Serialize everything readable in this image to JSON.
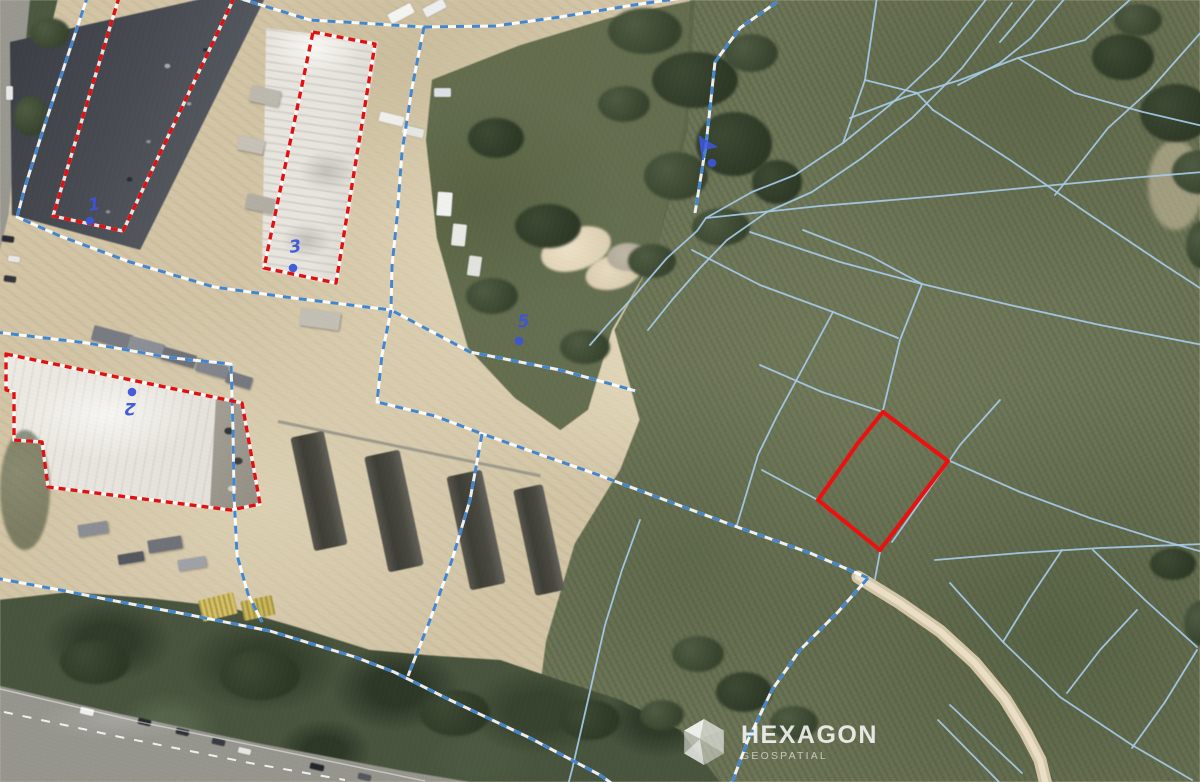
{
  "map": {
    "description": "aerial-cadastral-imagery",
    "watermark": {
      "line1": "HEXAGON",
      "line2": "GEOSPATIAL"
    },
    "colors": {
      "cadastral_line": "#a6cbe9",
      "boundary_dash": "#4286cf",
      "selection_red": "#ee0f0f",
      "label_blue": "#3b55d8",
      "field_green": "#6c7454",
      "sand": "#d4c5a4"
    },
    "parcel_labels": [
      {
        "text": "1",
        "x": 95,
        "y": 210,
        "rot": -10,
        "dot": [
          90,
          221
        ]
      },
      {
        "text": "3",
        "x": 296,
        "y": 252,
        "rot": -8,
        "dot": [
          293,
          268
        ]
      },
      {
        "text": "5",
        "x": 524,
        "y": 327,
        "rot": -5,
        "dot": [
          519,
          341
        ]
      },
      {
        "text": "2",
        "x": 130,
        "y": 403,
        "rot": 180,
        "dot": [
          132,
          392
        ]
      }
    ],
    "flag_marker": {
      "pole": [
        [
          700,
          136
        ],
        [
          703,
          160
        ]
      ],
      "pennant": [
        [
          699,
          136
        ],
        [
          718,
          147
        ],
        [
          701,
          151
        ]
      ],
      "dot": [
        712,
        163
      ]
    }
  },
  "overlay": {
    "boundary_lines": [
      {
        "points": [
          [
            88,
            -5
          ],
          [
            43,
            130
          ],
          [
            25,
            187
          ],
          [
            17,
            217
          ],
          [
            60,
            236
          ],
          [
            130,
            262
          ],
          [
            214,
            287
          ],
          [
            293,
            298
          ],
          [
            391,
            310
          ],
          [
            470,
            352
          ],
          [
            560,
            370
          ],
          [
            636,
            391
          ]
        ]
      },
      {
        "points": [
          [
            235,
            -3
          ],
          [
            310,
            20
          ],
          [
            424,
            27
          ],
          [
            412,
            88
          ],
          [
            402,
            152
          ],
          [
            397,
            218
          ],
          [
            392,
            266
          ],
          [
            391,
            310
          ]
        ]
      },
      {
        "points": [
          [
            424,
            27
          ],
          [
            495,
            26
          ],
          [
            560,
            17
          ],
          [
            640,
            4
          ],
          [
            690,
            -3
          ]
        ]
      },
      {
        "points": [
          [
            777,
            2
          ],
          [
            740,
            28
          ],
          [
            715,
            62
          ],
          [
            706,
            145
          ],
          [
            695,
            213
          ]
        ]
      },
      {
        "points": [
          [
            391,
            310
          ],
          [
            382,
            355
          ],
          [
            377,
            402
          ],
          [
            435,
            416
          ],
          [
            480,
            433
          ],
          [
            550,
            458
          ],
          [
            593,
            473
          ],
          [
            665,
            500
          ],
          [
            740,
            528
          ],
          [
            810,
            553
          ],
          [
            868,
            578
          ]
        ]
      },
      {
        "points": [
          [
            868,
            578
          ],
          [
            838,
            612
          ],
          [
            800,
            650
          ],
          [
            772,
            690
          ],
          [
            748,
            740
          ],
          [
            731,
            785
          ]
        ]
      },
      {
        "points": [
          [
            -5,
            578
          ],
          [
            60,
            590
          ],
          [
            110,
            600
          ],
          [
            190,
            615
          ],
          [
            270,
            631
          ],
          [
            355,
            657
          ],
          [
            394,
            672
          ],
          [
            450,
            700
          ],
          [
            530,
            738
          ],
          [
            600,
            775
          ],
          [
            614,
            785
          ]
        ]
      },
      {
        "points": [
          [
            -5,
            332
          ],
          [
            87,
            343
          ],
          [
            173,
            358
          ],
          [
            231,
            364
          ],
          [
            233,
            430
          ],
          [
            234,
            495
          ],
          [
            237,
            555
          ],
          [
            248,
            594
          ],
          [
            262,
            622
          ]
        ]
      },
      {
        "points": [
          [
            482,
            434
          ],
          [
            470,
            500
          ],
          [
            452,
            560
          ],
          [
            430,
            620
          ],
          [
            408,
            676
          ]
        ]
      }
    ],
    "parcel_lines": [
      {
        "points": [
          [
            877,
            -3
          ],
          [
            865,
            80
          ],
          [
            843,
            143
          ]
        ]
      },
      {
        "points": [
          [
            1066,
            -3
          ],
          [
            1031,
            38
          ],
          [
            1000,
            63
          ],
          [
            958,
            85
          ]
        ]
      },
      {
        "points": [
          [
            850,
            118
          ],
          [
            905,
            97
          ],
          [
            960,
            80
          ],
          [
            1018,
            58
          ],
          [
            1085,
            40
          ],
          [
            1133,
            -3
          ]
        ]
      },
      {
        "points": [
          [
            865,
            80
          ],
          [
            917,
            93
          ],
          [
            933,
            110
          ]
        ]
      },
      {
        "points": [
          [
            1203,
            30
          ],
          [
            1150,
            90
          ],
          [
            1108,
            128
          ],
          [
            1075,
            170
          ],
          [
            1055,
            195
          ]
        ]
      },
      {
        "points": [
          [
            1018,
            58
          ],
          [
            1075,
            93
          ],
          [
            1143,
            112
          ],
          [
            1203,
            126
          ]
        ]
      },
      {
        "points": [
          [
            988,
            -3
          ],
          [
            940,
            58
          ],
          [
            890,
            105
          ],
          [
            843,
            143
          ],
          [
            795,
            175
          ],
          [
            752,
            192
          ],
          [
            706,
            218
          ],
          [
            697,
            231
          ],
          [
            667,
            258
          ],
          [
            635,
            295
          ],
          [
            610,
            322
          ],
          [
            590,
            345
          ]
        ]
      },
      {
        "points": [
          [
            1012,
            3
          ],
          [
            962,
            68
          ],
          [
            912,
            118
          ],
          [
            862,
            158
          ],
          [
            812,
            192
          ],
          [
            767,
            212
          ],
          [
            727,
            240
          ],
          [
            700,
            268
          ],
          [
            672,
            300
          ],
          [
            648,
            330
          ]
        ]
      },
      {
        "points": [
          [
            933,
            110
          ],
          [
            1010,
            160
          ],
          [
            1090,
            215
          ],
          [
            1160,
            262
          ],
          [
            1203,
            290
          ]
        ]
      },
      {
        "points": [
          [
            706,
            218
          ],
          [
            820,
            206
          ],
          [
            940,
            196
          ],
          [
            1055,
            185
          ],
          [
            1130,
            178
          ],
          [
            1203,
            172
          ]
        ]
      },
      {
        "points": [
          [
            750,
            232
          ],
          [
            840,
            262
          ],
          [
            922,
            284
          ],
          [
            1010,
            305
          ],
          [
            1100,
            325
          ],
          [
            1203,
            345
          ]
        ]
      },
      {
        "points": [
          [
            692,
            250
          ],
          [
            760,
            285
          ],
          [
            833,
            312
          ],
          [
            898,
            338
          ]
        ]
      },
      {
        "points": [
          [
            833,
            312
          ],
          [
            803,
            368
          ],
          [
            777,
            416
          ],
          [
            758,
            455
          ],
          [
            737,
            525
          ]
        ]
      },
      {
        "points": [
          [
            922,
            284
          ],
          [
            900,
            340
          ],
          [
            883,
            410
          ]
        ]
      },
      {
        "points": [
          [
            880,
            552
          ],
          [
            875,
            579
          ]
        ]
      },
      {
        "points": [
          [
            760,
            365
          ],
          [
            822,
            392
          ],
          [
            880,
            411
          ]
        ]
      },
      {
        "points": [
          [
            950,
            461
          ],
          [
            1020,
            492
          ],
          [
            1090,
            518
          ],
          [
            1160,
            540
          ],
          [
            1203,
            552
          ]
        ]
      },
      {
        "points": [
          [
            762,
            470
          ],
          [
            816,
            499
          ]
        ]
      },
      {
        "points": [
          [
            1000,
            400
          ],
          [
            960,
            445
          ],
          [
            947,
            464
          ],
          [
            918,
            505
          ],
          [
            892,
            542
          ]
        ]
      },
      {
        "points": [
          [
            803,
            230
          ],
          [
            870,
            256
          ],
          [
            922,
            284
          ]
        ]
      },
      {
        "points": [
          [
            935,
            560
          ],
          [
            1020,
            553
          ],
          [
            1100,
            548
          ],
          [
            1203,
            544
          ]
        ]
      },
      {
        "points": [
          [
            950,
            583
          ],
          [
            1003,
            642
          ],
          [
            1060,
            697
          ],
          [
            1132,
            745
          ],
          [
            1192,
            780
          ]
        ]
      },
      {
        "points": [
          [
            1062,
            550
          ],
          [
            1030,
            598
          ],
          [
            1003,
            642
          ]
        ]
      },
      {
        "points": [
          [
            1137,
            610
          ],
          [
            1100,
            650
          ],
          [
            1067,
            693
          ]
        ]
      },
      {
        "points": [
          [
            1093,
            550
          ],
          [
            1145,
            600
          ],
          [
            1197,
            647
          ]
        ]
      },
      {
        "points": [
          [
            950,
            705
          ],
          [
            1022,
            773
          ]
        ]
      },
      {
        "points": [
          [
            938,
            720
          ],
          [
            1002,
            785
          ]
        ]
      },
      {
        "points": [
          [
            1197,
            650
          ],
          [
            1165,
            702
          ],
          [
            1132,
            748
          ]
        ]
      },
      {
        "points": [
          [
            640,
            520
          ],
          [
            622,
            570
          ],
          [
            605,
            625
          ],
          [
            588,
            700
          ],
          [
            572,
            770
          ],
          [
            568,
            785
          ]
        ]
      },
      {
        "points": [
          [
            1037,
            -3
          ],
          [
            1012,
            28
          ],
          [
            1000,
            42
          ]
        ]
      }
    ],
    "red_outlines": [
      {
        "name": "selected-building-1",
        "style": "dashed",
        "points": [
          [
            120,
            -6
          ],
          [
            236,
            -6
          ],
          [
            123,
            231
          ],
          [
            53,
            216
          ]
        ]
      },
      {
        "name": "selected-building-3",
        "style": "dashed",
        "points": [
          [
            313,
            32
          ],
          [
            375,
            44
          ],
          [
            336,
            283
          ],
          [
            264,
            268
          ]
        ]
      },
      {
        "name": "selected-building-2",
        "style": "dashed",
        "points": [
          [
            6,
            354
          ],
          [
            242,
            403
          ],
          [
            260,
            504
          ],
          [
            231,
            510
          ],
          [
            48,
            487
          ],
          [
            42,
            442
          ],
          [
            14,
            440
          ],
          [
            14,
            392
          ],
          [
            6,
            390
          ]
        ]
      },
      {
        "name": "selected-parcel",
        "style": "solid",
        "points": [
          [
            883,
            412
          ],
          [
            948,
            461
          ],
          [
            880,
            550
          ],
          [
            818,
            500
          ],
          [
            858,
            443
          ]
        ]
      }
    ],
    "terrain_paths": [
      {
        "points": [
          [
            858,
            577
          ],
          [
            900,
            603
          ],
          [
            940,
            631
          ],
          [
            975,
            663
          ],
          [
            1005,
            699
          ],
          [
            1026,
            733
          ],
          [
            1040,
            760
          ],
          [
            1046,
            785
          ]
        ]
      }
    ],
    "road_markings": [
      {
        "class": "road-dash",
        "points": [
          [
            4,
            712
          ],
          [
            120,
            737
          ],
          [
            250,
            763
          ],
          [
            345,
            780
          ]
        ]
      },
      {
        "class": "road-edge",
        "points": [
          [
            0,
            689
          ],
          [
            140,
            722
          ],
          [
            290,
            753
          ],
          [
            425,
            781
          ]
        ]
      }
    ]
  }
}
